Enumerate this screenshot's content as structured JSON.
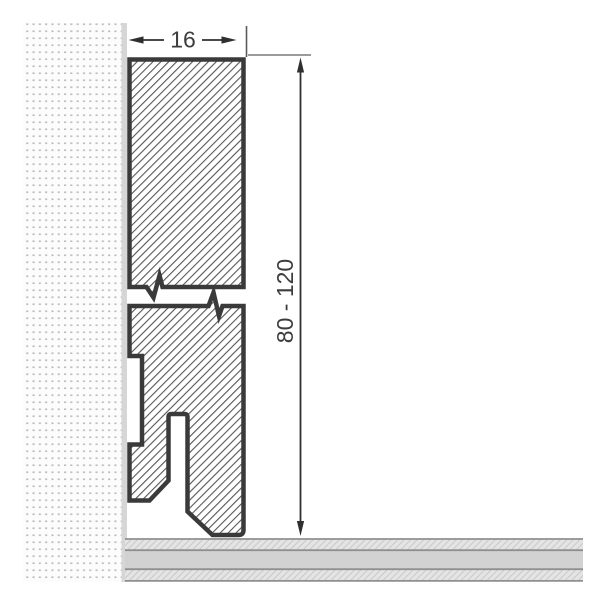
{
  "drawing": {
    "type": "skirting-board profile cross-section",
    "dimensions": {
      "width_label": "16",
      "height_label": "80 - 120"
    }
  },
  "colors": {
    "outline": "#3a3a3a",
    "hatch": "#565656",
    "dimension_lines": "#2f2f2f",
    "dimension_text": "#3d3d3d",
    "wall_background": "#fcfcfc",
    "wall_dots": "#bdbdbd",
    "wall_surface_strip": "#d6d6d6",
    "floor_lines": "#8f8f8f",
    "floor_core": "#d2d2d2",
    "floor_hatch_background": "#e4e4e4",
    "floor_hatch": "#c6c6c6",
    "page_background": "#ffffff"
  }
}
